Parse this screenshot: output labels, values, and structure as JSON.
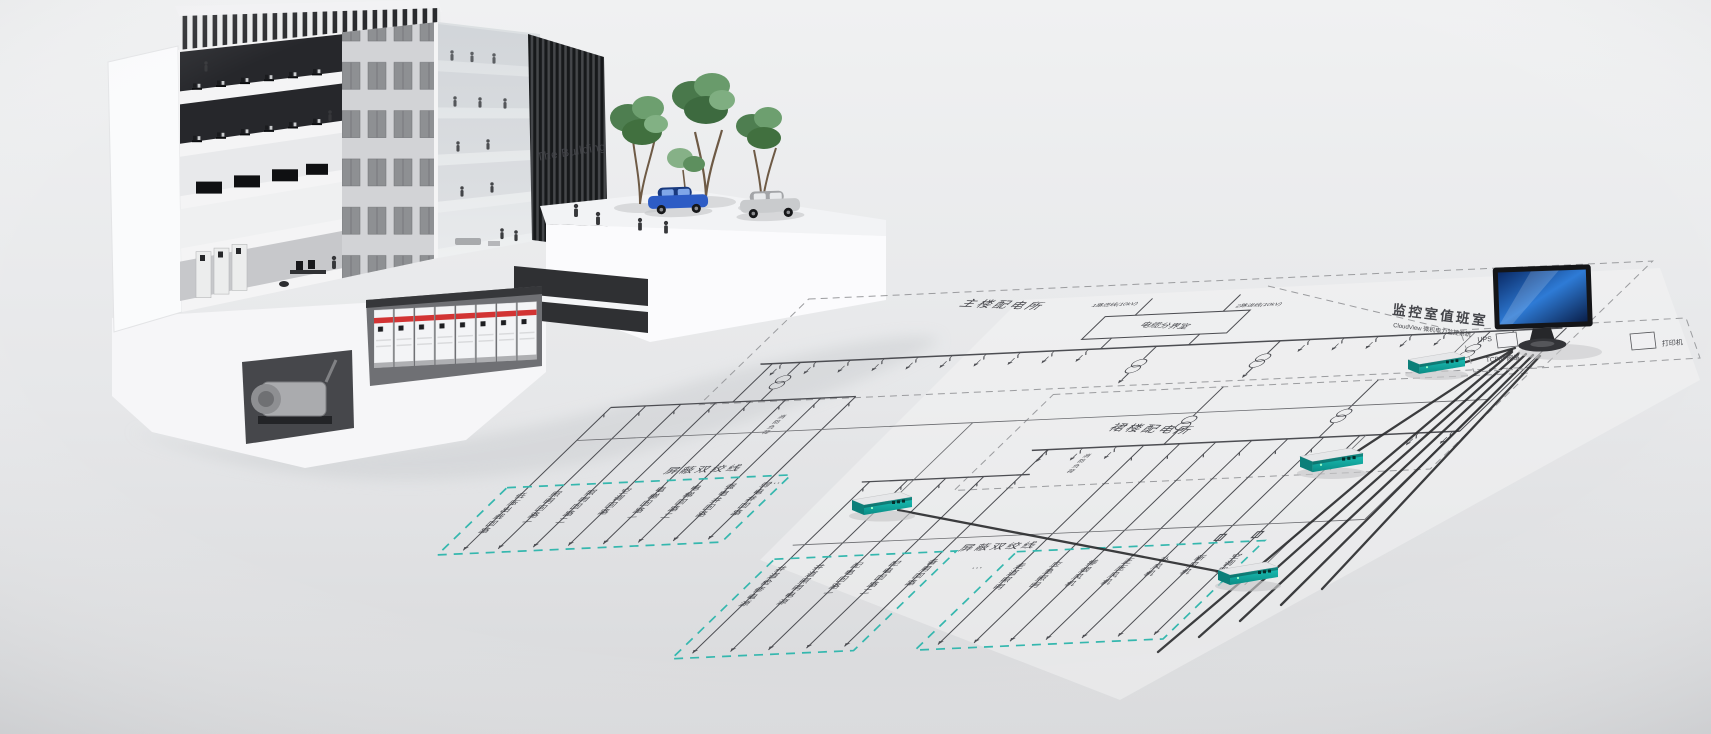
{
  "building": {
    "sign_text": "The Building"
  },
  "diagram": {
    "main_station": "主楼配电所",
    "podium_station": "裙楼配电所",
    "cable_room": "电缆分界室",
    "incoming_1": "1路进线(10kV)",
    "incoming_2": "2路进线(10kV)",
    "fire_load": "消防负荷",
    "shielded_twisted_pair": "屏蔽双绞线",
    "ellipsis": "…",
    "group1_circuits": [
      "低压出线回路",
      "照明回路一",
      "照明回路二",
      "空调回路",
      "电梯回路一",
      "电梯回路二",
      "强电井回路",
      "弱电井回路"
    ],
    "group2_circuits": [
      "井道检修电源",
      "井道照明电源",
      "配电回路一",
      "配电回路二",
      "备用回路"
    ],
    "group3_circuits": [
      "走道照明",
      "应急照明",
      "排烟风机",
      "正压风机",
      "补风机",
      "新风机",
      "空调器"
    ]
  },
  "monitoring_room": {
    "title": "监控室值班室",
    "subtitle": "CloudView 微机电力监控系统",
    "ups_label": "UPS",
    "printer_label": "打印机",
    "network_label": "TCP/IP网络"
  },
  "colors": {
    "teal_dash": "#35b7ae",
    "schematic_line": "#4c4d52",
    "screen_blue": "#1a66c4",
    "cabinet_red": "#d23434",
    "device_teal": "#17b3aa"
  }
}
